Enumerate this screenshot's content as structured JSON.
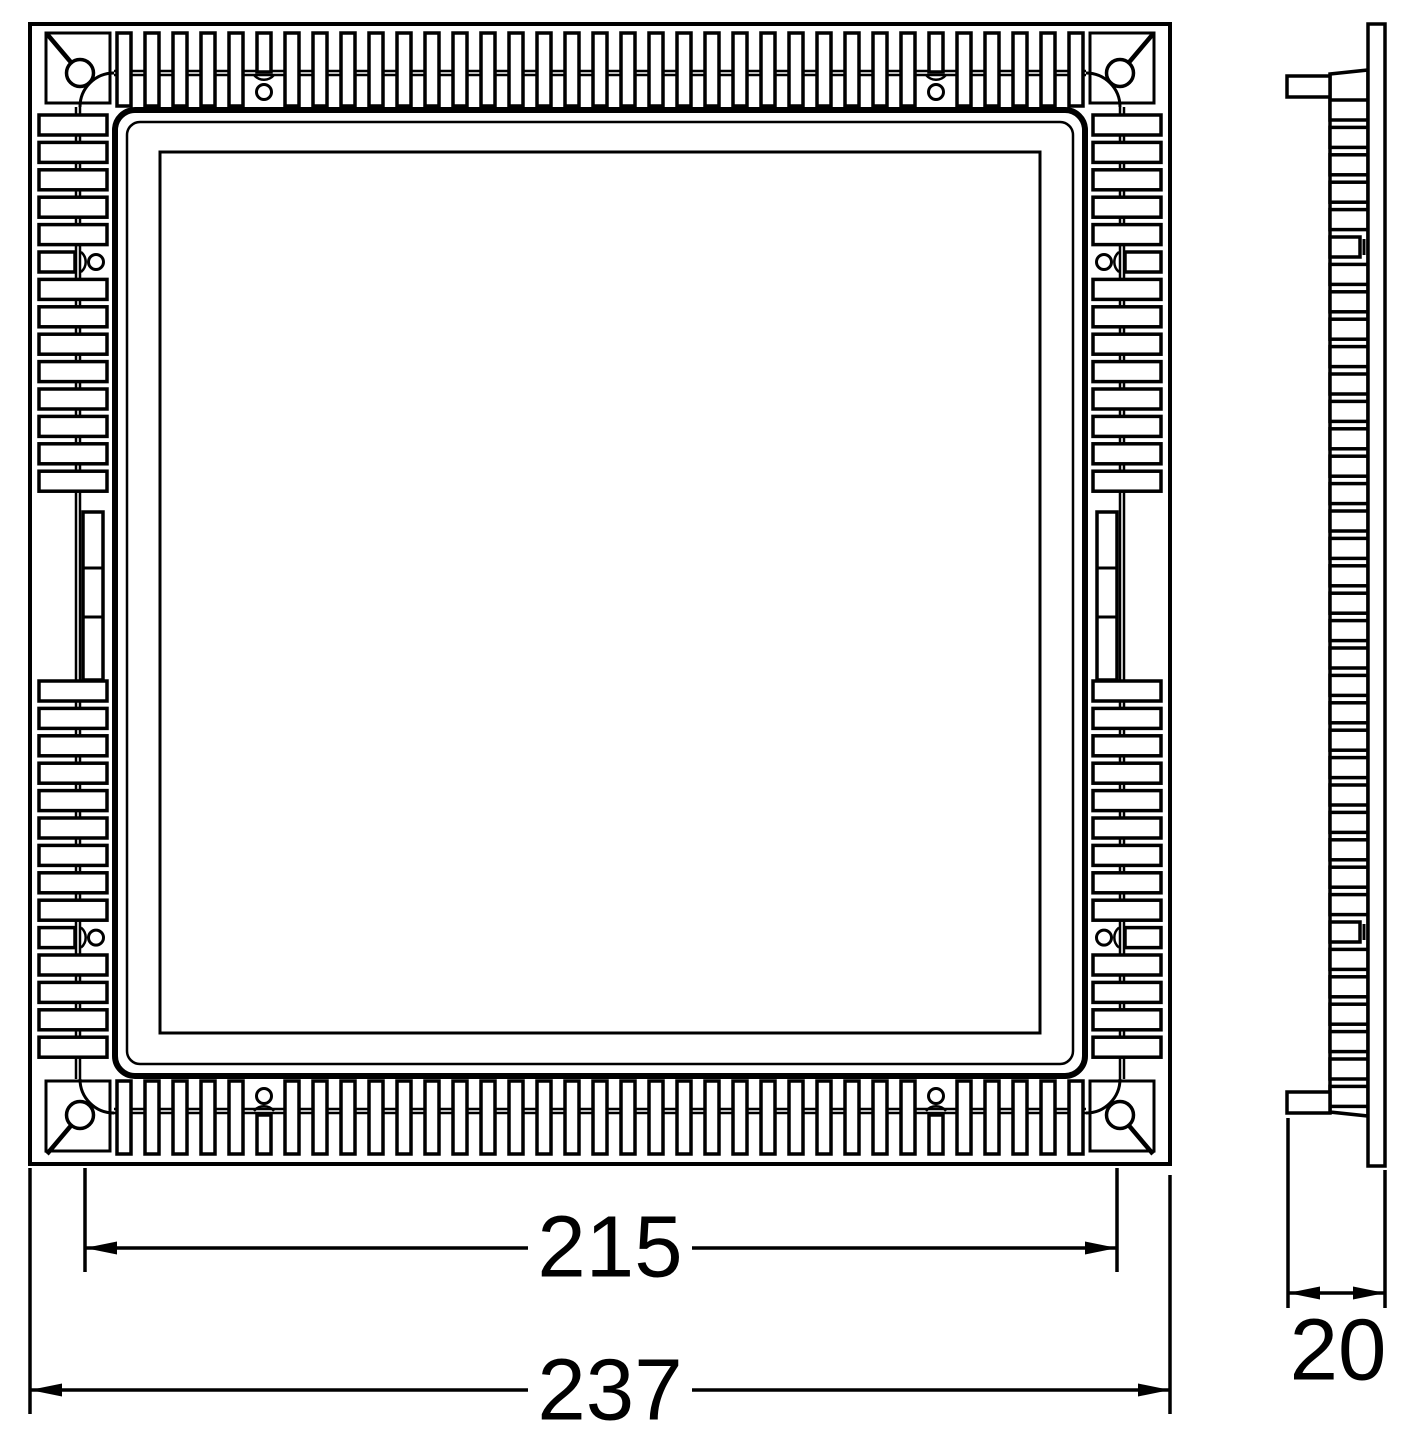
{
  "drawing": {
    "kind": "technical-drawing",
    "views": {
      "front": {
        "id": "front-view"
      },
      "side": {
        "id": "side-view"
      }
    },
    "dimensions": {
      "inner_width": "215",
      "outer_width": "237",
      "depth": "20"
    },
    "colors": {
      "line": "#000000",
      "background": "#ffffff"
    }
  }
}
